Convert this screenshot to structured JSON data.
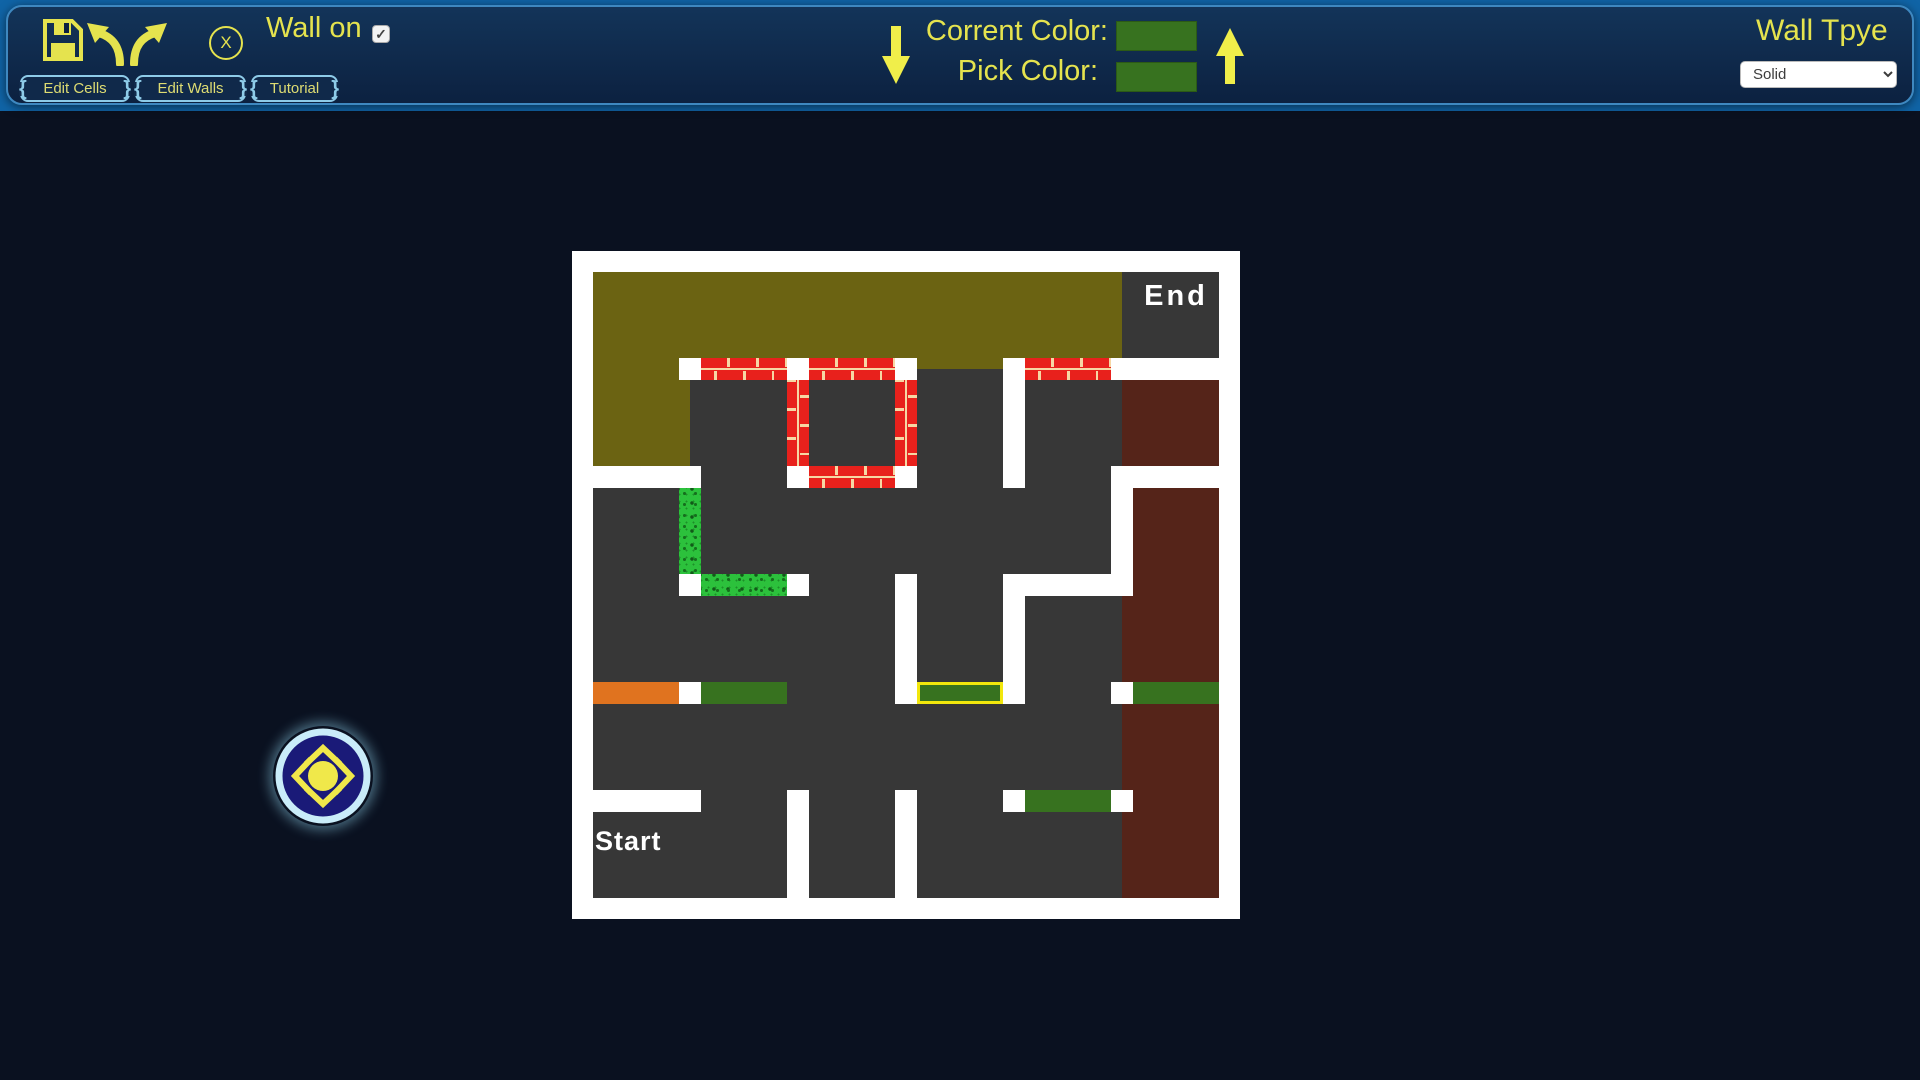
{
  "topbar": {
    "icons": {
      "save": "floppy-disk",
      "undo": "undo-arrow",
      "redo": "redo-arrow"
    },
    "clear_button_label": "X",
    "wall_toggle": {
      "label": "Wall on",
      "checked": true,
      "checkmark": "✓"
    },
    "menu_buttons": [
      "Edit Cells",
      "Edit Walls",
      "Tutorial"
    ],
    "color_panel": {
      "current_label": "Corrent Color:",
      "pick_label": "Pick Color:",
      "current_color": "#37721f",
      "pick_color": "#37721f",
      "down_arrow_icon": "arrow-down",
      "up_arrow_icon": "arrow-up"
    },
    "wall_type": {
      "label": "Wall Tpye",
      "selected": "Solid"
    },
    "accent_text_color": "#e5e34e"
  },
  "compass": {
    "icon": "dpad-compass",
    "ring_color": "#c9ecf9",
    "face_color": "#1a1a78",
    "glyph_color": "#f0e84a"
  },
  "maze": {
    "rows": 6,
    "cols": 6,
    "palette": {
      "white": "#ffffff",
      "gray": "#373737",
      "olive": "#6b6312",
      "brown": "#552419",
      "orange": "#e0731f",
      "dgreen": "#37721f",
      "brick": "#e8211c",
      "mortar": "#f6d7a4",
      "grass": "#2cc13c",
      "highlight": "#f2e70c"
    },
    "cells": [
      [
        "olive",
        "olive",
        "olive",
        "olive",
        "olive",
        "gray"
      ],
      [
        "olive",
        "gray",
        "gray",
        "gray",
        "gray",
        "brown"
      ],
      [
        "gray",
        "gray",
        "gray",
        "gray",
        "gray",
        "brown"
      ],
      [
        "gray",
        "gray",
        "gray",
        "gray",
        "gray",
        "brown"
      ],
      [
        "gray",
        "gray",
        "gray",
        "gray",
        "gray",
        "brown"
      ],
      [
        "gray",
        "gray",
        "gray",
        "gray",
        "gray",
        "brown"
      ]
    ],
    "h_walls": [
      [
        "off",
        "brick",
        "brick",
        "off",
        "brick",
        "white"
      ],
      [
        "white",
        "off",
        "brick",
        "off",
        "off",
        "white"
      ],
      [
        "off",
        "grass",
        "off",
        "off",
        "white",
        "off"
      ],
      [
        "orange",
        "dgreen",
        "off",
        "selected",
        "off",
        "dgreen"
      ],
      [
        "white",
        "off",
        "off",
        "off",
        "dgreen",
        "off"
      ]
    ],
    "v_walls": [
      [
        "off",
        "off",
        "off",
        "off",
        "off"
      ],
      [
        "off",
        "brick",
        "brick",
        "white",
        "off"
      ],
      [
        "grass",
        "off",
        "off",
        "off",
        "white"
      ],
      [
        "off",
        "off",
        "white",
        "white",
        "off"
      ],
      [
        "off",
        "off",
        "off",
        "off",
        "off"
      ],
      [
        "off",
        "white",
        "white",
        "off",
        "off"
      ]
    ],
    "gray_corners": [
      [
        3,
        1
      ]
    ],
    "labels": [
      {
        "text": "End",
        "row": 0,
        "col": 5,
        "align": "center",
        "dx": 0,
        "dy": 8,
        "size": 29,
        "spacing": 3
      },
      {
        "text": "Start",
        "row": 5,
        "col": 0,
        "align": "left",
        "dx": 2,
        "dy": 14,
        "size": 27,
        "spacing": 1
      }
    ]
  }
}
